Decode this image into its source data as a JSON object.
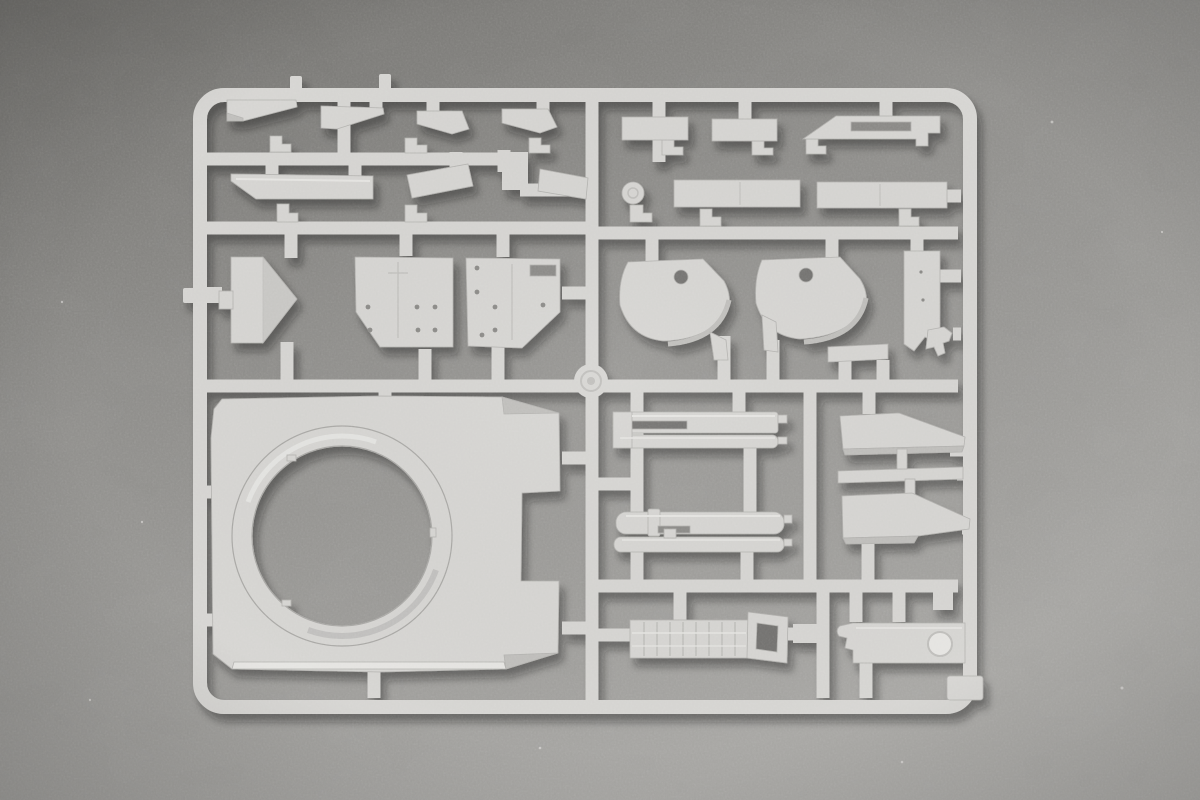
{
  "scene": {
    "alt": "photo of a light-gray injection-molded model kit sprue (parts tree) lying on a gray textured surface",
    "visible_text": "",
    "part_names": [
      "sprue-frame",
      "runner-network",
      "center-boss",
      "wedge-bracket-1",
      "wedge-bracket-2",
      "wedge-bracket-3",
      "wedge-bracket-4",
      "hull-bar-long",
      "hull-bar-left",
      "hull-bar-right",
      "rect-panel-1",
      "rect-panel-2",
      "vent-cover-panel",
      "long-panel-1",
      "long-panel-2",
      "round-cap",
      "glacis-arrow-plate",
      "hatch-plate-left",
      "hatch-plate-right",
      "fender-cover-left",
      "fender-cover-right",
      "side-plate",
      "hook-bracket",
      "small-bar",
      "turret-roof-with-ring",
      "gun-barrel-pair-upper",
      "gun-barrel-pair-lower",
      "armor-wedge-upper",
      "thin-strip",
      "armor-wedge-lower",
      "muffler-box",
      "tow-loop",
      "stowage-plate",
      "corner-pad",
      "angle-clip",
      "gate-nub",
      "dust-speck"
    ]
  },
  "colors": {
    "bg_dark": "#6e6d6a",
    "bg_mid": "#8c8b88",
    "bg_light": "#9d9c99",
    "bg_lighter": "#a7a6a3",
    "plastic": "#d6d5d2",
    "plastic_light": "#e6e5e2",
    "plastic_shade": "#bfbebb",
    "plastic_dark": "#a9a8a5",
    "edge_line": "#b3b2af",
    "hole_dark": "#73726f",
    "slot_dark": "#8a8986",
    "shadow": "#1a1a18"
  }
}
